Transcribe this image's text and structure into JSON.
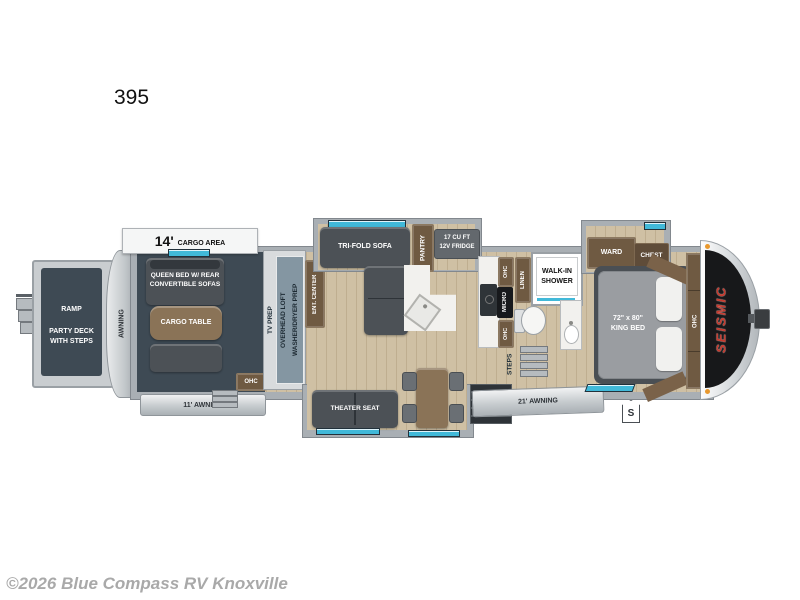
{
  "title": "395",
  "watermark": "©2026 Blue Compass RV Knoxville",
  "colors": {
    "accent_teal": "#41b9d9",
    "wood": "#cbbb9e",
    "cargo_slate": "#3e4a54",
    "cabinet_brown": "#6f5a42",
    "furniture_grey": "#4c5156",
    "brand_red": "#c43a2e"
  },
  "exterior": {
    "brand": "SEISMIC",
    "cargo_length": "14'",
    "cargo_area_label": "CARGO AREA",
    "rear_awning": "AWNING",
    "awning_11": "11' AWNING",
    "awning_21": "21' AWNING",
    "s_badge": "S"
  },
  "garage": {
    "ramp": "RAMP",
    "party_deck_line1": "PARTY DECK",
    "party_deck_line2": "WITH STEPS",
    "queen_bed_line1": "QUEEN BED W/ REAR",
    "queen_bed_line2": "CONVERTIBLE SOFAS",
    "cargo_table": "CARGO TABLE",
    "ohc": "OHC",
    "tv_prep": "TV PREP",
    "overhead_loft": "OVERHEAD LOFT",
    "washer_dryer_prep": "WASHER/DRYER PREP"
  },
  "living": {
    "ent_center": "ENT. CENTER",
    "trifold_sofa": "TRI-FOLD SOFA",
    "pantry": "PANTRY",
    "fridge_line1": "17 CU FT",
    "fridge_line2": "12V FRIDGE",
    "ohc_top": "OHC",
    "micro": "MICRO",
    "ohc_bottom": "OHC",
    "theater_seat": "THEATER SEAT"
  },
  "bath": {
    "linen": "LINEN",
    "shower_line1": "WALK-IN",
    "shower_line2": "SHOWER"
  },
  "bedroom": {
    "steps": "STEPS",
    "ward": "WARD",
    "chest": "CHEST",
    "king_line1": "72\" x 80\"",
    "king_line2": "KING BED",
    "ohc": "OHC"
  }
}
